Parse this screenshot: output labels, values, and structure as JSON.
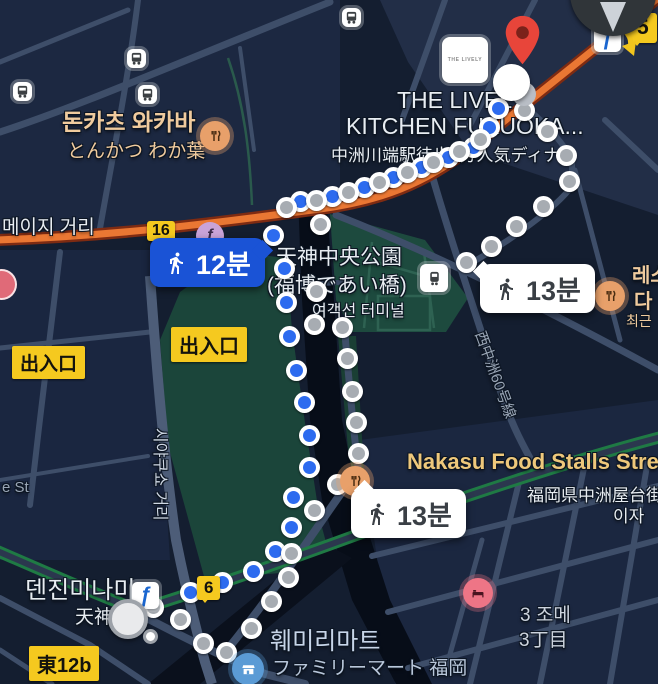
{
  "map": {
    "labels": {
      "meiji_road": "메이지 거리",
      "tonkatsu_ko": "돈카츠 와카바",
      "tonkatsu_ja": "とんかつ わか葉",
      "park_line1": "天神中央公園",
      "park_line2": "(福博であい橋)",
      "ferry_terminal": "여객선 터미널",
      "exit_1": "出入口",
      "exit_2": "出入口",
      "lively_line1": "THE LIVELY",
      "lively_line2": "KITCHEN FUKUOKA...",
      "lively_sub": "中洲川端駅徒歩1分人気ディナー",
      "lively_logo": "THE LIVELY",
      "nakasu_title": "Nakasu Food Stalls Stre",
      "nakasu_sub": "福岡県中洲屋台街",
      "nakasu_sub2": "이자",
      "resto_line1": "레스",
      "resto_line2": "다",
      "resto_line3": "최근",
      "tenjin_minami": "덴진미나미",
      "tenjin_ja": "天神",
      "higashi_exit": "東12b",
      "familymart_ko": "훼미리마트",
      "familymart_ja": "ファミリーマート 福岡",
      "chome_ko": "3 조메",
      "chome_ja": "3丁目",
      "shiyakusho_road": "시야쿠쇼 거리",
      "nishinakasu_road": "西中洲60号線",
      "est_road": "e St"
    },
    "shields": {
      "s16": "16",
      "s6": "6",
      "s5": "5"
    },
    "badges": {
      "walk12": {
        "time": "12분"
      },
      "walk13_right": {
        "time": "13분"
      },
      "walk13_bottom": {
        "time": "13분"
      }
    },
    "icons": {
      "bus": "bus-icon",
      "restaurant": "fork-knife-icon",
      "hotel": "bed-icon",
      "convenience_store": "store-icon",
      "subway_logo": "fukuoka-subway-f-icon",
      "train_station": "train-icon",
      "destination_pin": "red-map-pin",
      "compass": "north-compass"
    },
    "colors": {
      "route_blue": "#2d6bef",
      "route_gray": "#a7acb2",
      "badge_blue": "#1a53d6",
      "road_orange": "#ea7733",
      "shield_yellow": "#f5c91f",
      "park_green": "#1d4a3e",
      "label_tan": "#f0cb9e",
      "label_yellow": "#eec87b"
    },
    "routes": {
      "blue": [
        [
          273,
          235
        ],
        [
          300,
          201
        ],
        [
          332,
          196
        ],
        [
          364,
          187
        ],
        [
          393,
          177
        ],
        [
          421,
          167
        ],
        [
          448,
          157
        ],
        [
          473,
          147
        ],
        [
          489,
          127
        ],
        [
          498,
          108
        ],
        [
          284,
          268
        ],
        [
          286,
          302
        ],
        [
          289,
          336
        ],
        [
          296,
          370
        ],
        [
          304,
          402
        ],
        [
          309,
          435
        ],
        [
          309,
          467
        ],
        [
          293,
          497
        ],
        [
          291,
          527
        ],
        [
          275,
          551
        ],
        [
          253,
          571
        ],
        [
          222,
          582
        ],
        [
          190,
          592
        ]
      ],
      "gray": [
        [
          286,
          207
        ],
        [
          316,
          200
        ],
        [
          348,
          192
        ],
        [
          379,
          182
        ],
        [
          407,
          172
        ],
        [
          433,
          162
        ],
        [
          459,
          151
        ],
        [
          480,
          139
        ],
        [
          524,
          110
        ],
        [
          547,
          131
        ],
        [
          566,
          155
        ],
        [
          569,
          181
        ],
        [
          543,
          206
        ],
        [
          516,
          226
        ],
        [
          491,
          246
        ],
        [
          466,
          262
        ],
        [
          320,
          224
        ],
        [
          316,
          291
        ],
        [
          314,
          324
        ],
        [
          342,
          327
        ],
        [
          347,
          358
        ],
        [
          352,
          391
        ],
        [
          356,
          422
        ],
        [
          358,
          453
        ],
        [
          337,
          484
        ],
        [
          314,
          510
        ],
        [
          291,
          553
        ],
        [
          288,
          577
        ],
        [
          271,
          601
        ],
        [
          251,
          628
        ],
        [
          226,
          652
        ],
        [
          203,
          643
        ],
        [
          180,
          619
        ],
        [
          153,
          607
        ]
      ]
    }
  }
}
